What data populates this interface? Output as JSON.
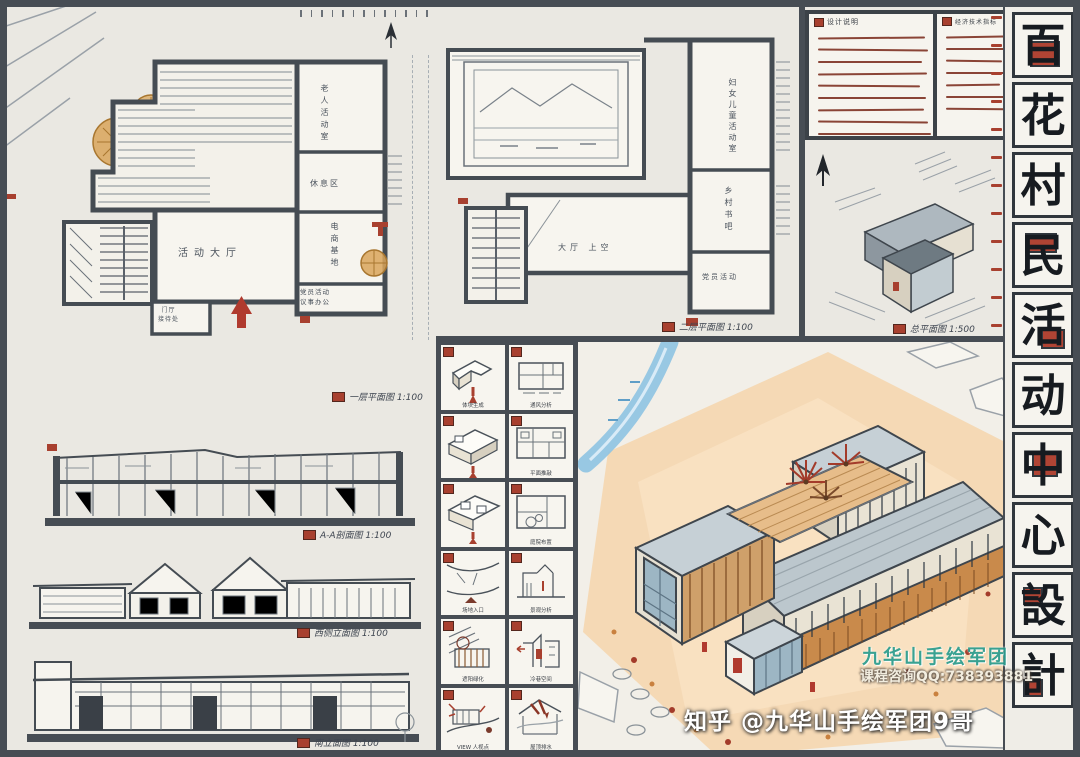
{
  "board_title": "百花村民活动中心設計",
  "title_strip": {
    "chars": [
      "百",
      "花",
      "村",
      "民",
      "活",
      "动",
      "中",
      "心",
      "設",
      "計"
    ]
  },
  "notes": {
    "design_title": "设计说明",
    "tech_title": "经济技术指标"
  },
  "plans": {
    "plan1": {
      "caption": "一层平面图 1:100",
      "rooms": {
        "hall": "活动大厅",
        "elderly": "老人活动室",
        "rest": "休息区",
        "ecommerce": "电商基地",
        "party": "党员活动\n议事办公",
        "foyer": "门厅\n接待处"
      }
    },
    "plan2": {
      "caption": "二层平面图 1:100",
      "rooms": {
        "women_children": "妇女儿童活动室",
        "bookbar": "乡村书吧",
        "party": "党员活动",
        "hall_void": "大厅 上空"
      }
    },
    "site": {
      "caption": "总平面图 1:500"
    }
  },
  "drawings": {
    "section_caption": "A-A剖面图 1:100",
    "west_elev_caption": "西侧立面图 1:100",
    "south_elev_caption": "南立面图 1:100"
  },
  "analysis": {
    "cells": [
      "体块生成",
      "通风分析",
      "",
      "平面推敲",
      "",
      "庭院布置",
      "场地入口",
      "景观分析",
      "遮阳绿化",
      "冷巷空间",
      "VIEW 人视点",
      "屋顶排水"
    ]
  },
  "watermark": {
    "studio": "九华山手绘军团",
    "contact": "课程咨询QQ:738393881",
    "zhihu": "知乎 @九华山手绘军团9哥"
  },
  "colors": {
    "accent_red": "#a8402f",
    "frame_gray": "#474d54",
    "wood_orange": "#c98a4b",
    "peach_ground": "#f5d3a8",
    "water_blue": "#8ec3e2",
    "teal_watermark": "#2a9d8f",
    "note_line_brown": "#8a4436",
    "glass_blue": "#9db6c4"
  }
}
